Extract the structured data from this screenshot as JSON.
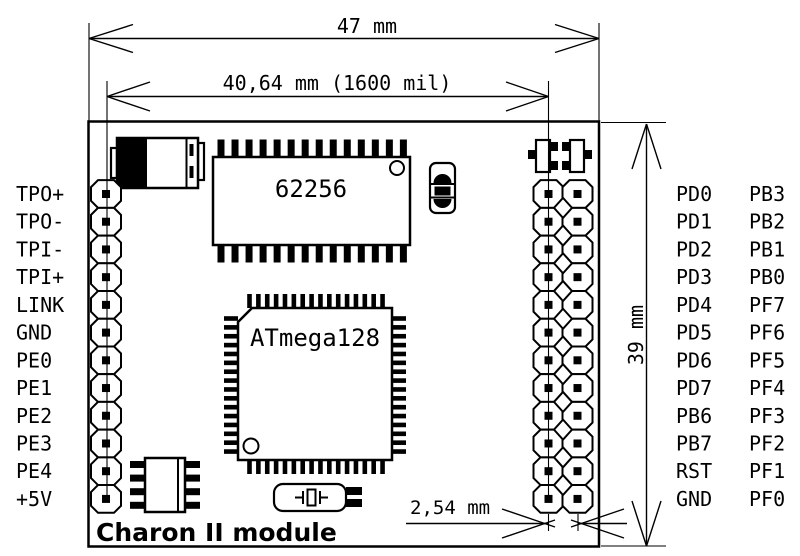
{
  "diagram": {
    "title": "Charon II module",
    "dims": {
      "width": "47 mm",
      "header_span": "40,64 mm (1600 mil)",
      "height": "39 mm",
      "pitch": "2,54 mm"
    },
    "components": {
      "sram": "62256",
      "mcu": "ATmega128"
    },
    "left_pins": [
      "TPO+",
      "TPO-",
      "TPI-",
      "TPI+",
      "LINK",
      "GND",
      "PE0",
      "PE1",
      "PE2",
      "PE3",
      "PE4",
      "+5V"
    ],
    "right_pins_col1": [
      "PD0",
      "PD1",
      "PD2",
      "PD3",
      "PD4",
      "PD5",
      "PD6",
      "PD7",
      "PB6",
      "PB7",
      "RST",
      "GND"
    ],
    "right_pins_col2": [
      "PB3",
      "PB2",
      "PB1",
      "PB0",
      "PF7",
      "PF6",
      "PF5",
      "PF4",
      "PF3",
      "PF2",
      "PF1",
      "PF0"
    ]
  }
}
